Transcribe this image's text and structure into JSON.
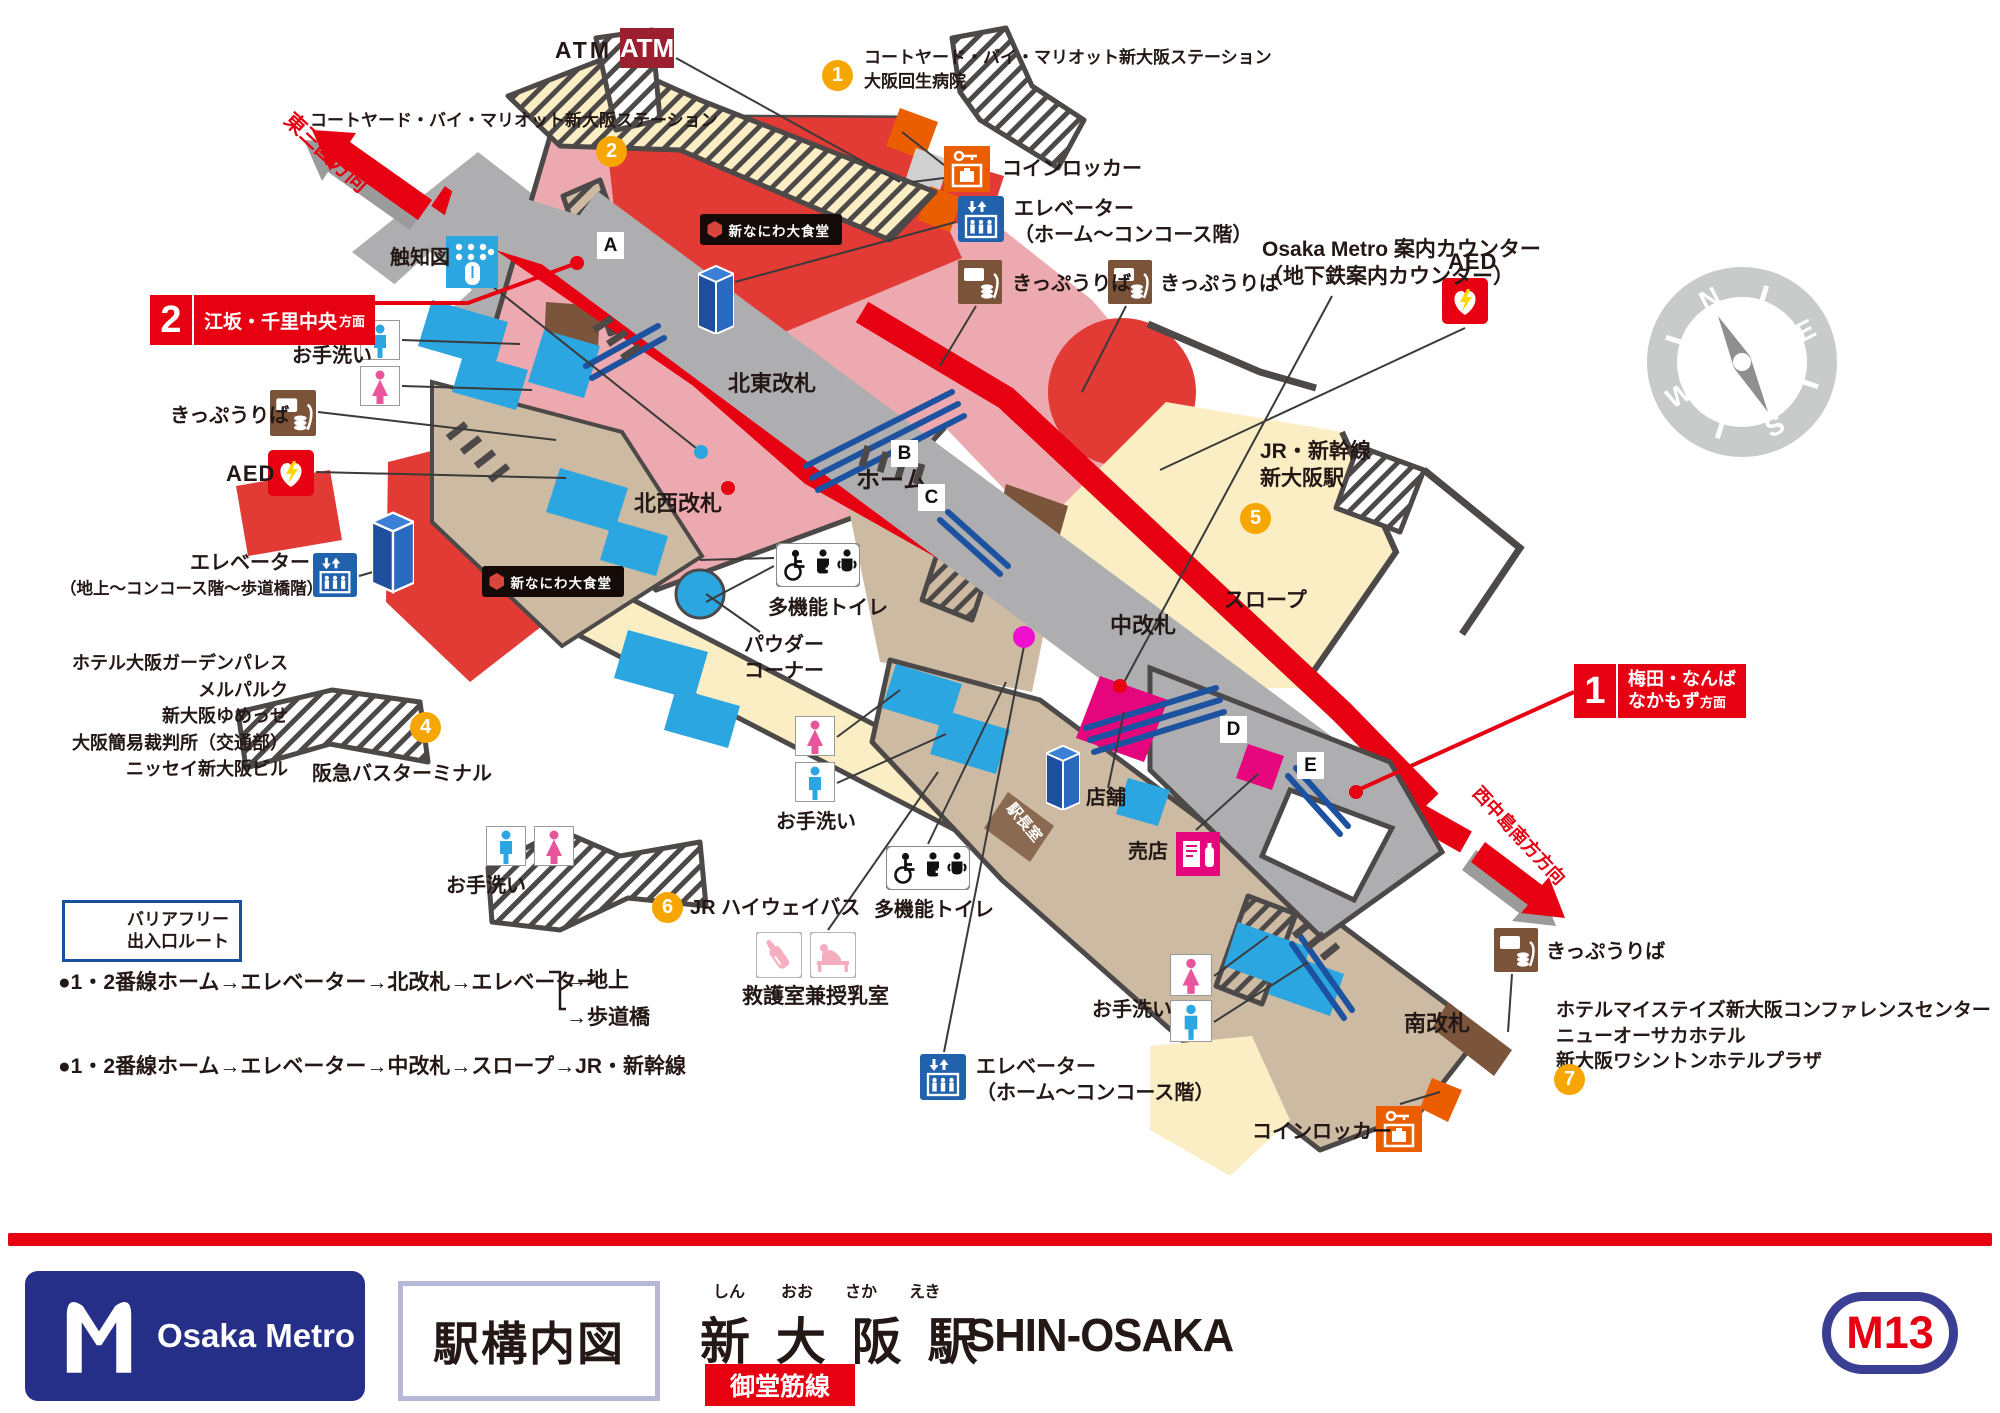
{
  "map": {
    "atm": {
      "label": "ATM",
      "badge": "ATM"
    },
    "exits": {
      "e1": {
        "no": "1",
        "line1": "コートヤード・バイ・マリオット新大阪ステーション",
        "line2": "大阪回生病院"
      },
      "e2": {
        "no": "2",
        "label": "コートヤード・バイ・マリオット新大阪ステーション"
      },
      "e4": {
        "no": "4"
      },
      "e5": {
        "no": "5"
      },
      "e6": {
        "no": "6",
        "label": "JR ハイウェイバス"
      },
      "e7": {
        "no": "7"
      }
    },
    "facilities": {
      "coinlocker_top": "コインロッカー",
      "elevator_top_1": "エレベーター",
      "elevator_top_2": "（ホーム～コンコース階）",
      "ticket_top1": "きっぷうりば",
      "ticket_top2": "きっぷうりば",
      "counter_1": "Osaka Metro 案内カウンター",
      "counter_2": "（地下鉄案内カウンター）",
      "aed_right": "AED",
      "tactile": "触知図",
      "toilet_nw": "お手洗い",
      "ticket_left": "きっぷうりば",
      "aed_left": "AED",
      "elevator_left_1": "エレベーター",
      "elevator_left_2": "（地上～コンコース階～歩道橋階）",
      "toilet_sw": "お手洗い",
      "mf_toilet_1": "多機能トイレ",
      "powder_1": "パウダー",
      "powder_2": "コーナー",
      "toilet_center": "お手洗い",
      "mf_toilet_2": "多機能トイレ",
      "rescue": "救護室兼授乳室",
      "elevator_bottom_1": "エレベーター",
      "elevator_bottom_2": "（ホーム～コンコース階）",
      "tenpo": "店舗",
      "baiten": "売店",
      "toilet_south": "お手洗い",
      "coinlocker_south": "コインロッカー",
      "ticket_se": "きっぷうりば",
      "stationmaster": "駅長室"
    },
    "gates": {
      "ne": "北東改札",
      "nw": "北西改札",
      "middle": "中改札",
      "south": "南改札"
    },
    "areas": {
      "platform": "ホーム",
      "slope": "スロープ",
      "jr_1": "JR・新幹線",
      "jr_2": "新大阪駅",
      "hankyu": "阪急バスターミナル",
      "restaurant": "新なにわ大食堂"
    },
    "platform_badges": {
      "a": "A",
      "b": "B",
      "c": "C",
      "d": "D",
      "e": "E"
    },
    "banners": {
      "p2": {
        "no": "2",
        "dest": "江坂・千里中央",
        "suffix": "方面"
      },
      "p1": {
        "no": "1",
        "dest1": "梅田・なんば",
        "dest2": "なかもず",
        "suffix": "方面"
      }
    },
    "directions": {
      "ne": "東三国方向",
      "se": "西中島南方方向"
    },
    "hotels_west": [
      "ホテル大阪ガーデンパレス",
      "メルパルク",
      "新大阪ゆめっせ",
      "大阪簡易裁判所（交通部）",
      "ニッセイ新大阪ビル"
    ],
    "hotels_se": [
      "ホテルマイステイズ新大阪コンファレンスセンター",
      "ニューオーサカホテル",
      "新大阪ワシントンホテルプラザ"
    ],
    "compass": {
      "n": "N",
      "e": "E",
      "s": "S",
      "w": "W"
    }
  },
  "legend": {
    "barrier_free_1": "バリアフリー",
    "barrier_free_2": "出入口ルート",
    "route1": "●1・2番線ホーム→エレベーター→北改札→エレベーター",
    "route1_branch1": "→地上",
    "route1_branch2": "→歩道橋",
    "route2": "●1・2番線ホーム→エレベーター→中改札→スロープ→JR・新幹線"
  },
  "footer": {
    "brand": "Osaka Metro",
    "map_title": "駅構内図",
    "furigana": [
      "しん",
      "おお",
      "さか",
      "えき"
    ],
    "station_kanji": "新 大 阪 駅",
    "station_en": "SHIN-OSAKA",
    "line_badge": "御堂筋線",
    "station_code": "M13"
  },
  "colors": {
    "line_red": "#e60012",
    "building_red": "#e23a34",
    "pink": "#ecaab0",
    "cream": "#fbeec5",
    "gray": "#aeaeb0",
    "tan": "#cdbaa3",
    "brown": "#7a5338",
    "blue": "#2ca6e0",
    "navy": "#2262ad",
    "marker_orange": "#f7a600",
    "locker_orange": "#ea5e00",
    "magenta": "#e5067e",
    "footer_navy": "#262f87"
  }
}
